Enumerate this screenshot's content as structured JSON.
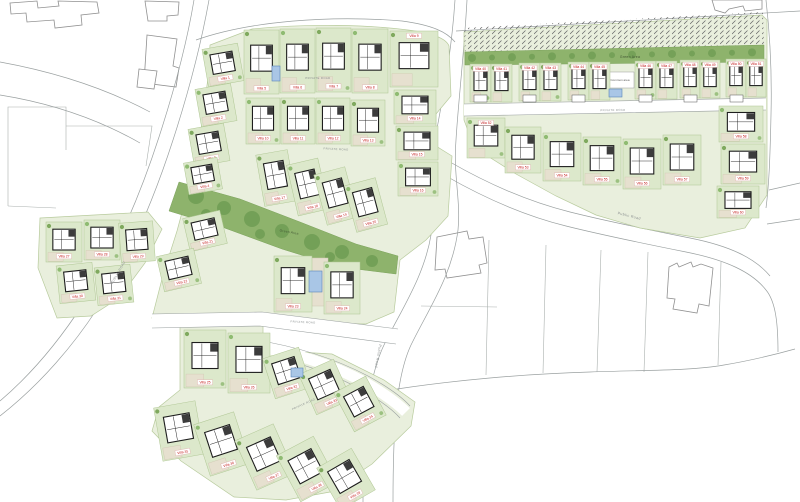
{
  "labels": {
    "green_area": "Green Area",
    "common_area": "Common area",
    "private_road": "PRIVATE ROAD",
    "public_road": "Public Road",
    "public_road_upper": "PUBLIC ROAD"
  },
  "colors": {
    "plot_green": "#dce8cb",
    "base_green": "#e9efdd",
    "band_green": "#8eb36c",
    "tree_dark": "#6f9c54",
    "tree_light": "#8fbb72",
    "terrace": "#e6e0cf",
    "villa_label": "#c52222",
    "road_line": "#9aa0a0",
    "pool": "#a9c6e6"
  },
  "villas": [
    {
      "label": "Villa 1",
      "x": 205,
      "y": 46,
      "w": 36,
      "h": 38,
      "r": -10
    },
    {
      "label": "Villa 2",
      "x": 198,
      "y": 86,
      "w": 36,
      "h": 38,
      "r": -10
    },
    {
      "label": "Villa 3",
      "x": 191,
      "y": 126,
      "w": 36,
      "h": 38,
      "r": -10
    },
    {
      "label": "Villa 4",
      "x": 186,
      "y": 160,
      "w": 34,
      "h": 32,
      "r": -10
    },
    {
      "label": "Villa 5",
      "x": 244,
      "y": 30,
      "w": 35,
      "h": 64,
      "r": 0
    },
    {
      "label": "Villa 6",
      "x": 280,
      "y": 29,
      "w": 35,
      "h": 64,
      "r": 0
    },
    {
      "label": "Villa 7",
      "x": 316,
      "y": 28,
      "w": 35,
      "h": 64,
      "r": 0
    },
    {
      "label": "Villa 8",
      "x": 352,
      "y": 29,
      "w": 36,
      "h": 64,
      "r": 0
    },
    {
      "label": "Villa 9",
      "x": 390,
      "y": 31,
      "w": 48,
      "h": 56,
      "r": 0,
      "lp": "t"
    },
    {
      "label": "Villa 10",
      "x": 246,
      "y": 98,
      "w": 34,
      "h": 46,
      "r": 0
    },
    {
      "label": "Villa 11",
      "x": 281,
      "y": 98,
      "w": 34,
      "h": 46,
      "r": 0
    },
    {
      "label": "Villa 12",
      "x": 316,
      "y": 98,
      "w": 34,
      "h": 46,
      "r": 0
    },
    {
      "label": "Villa 13",
      "x": 351,
      "y": 100,
      "w": 34,
      "h": 46,
      "r": 0
    },
    {
      "label": "Villa 14",
      "x": 394,
      "y": 90,
      "w": 42,
      "h": 34,
      "r": 0
    },
    {
      "label": "Villa 15",
      "x": 396,
      "y": 126,
      "w": 42,
      "h": 34,
      "r": 0
    },
    {
      "label": "Villa 16",
      "x": 398,
      "y": 162,
      "w": 40,
      "h": 34,
      "r": 0
    },
    {
      "label": "Villa 17",
      "x": 260,
      "y": 152,
      "w": 32,
      "h": 52,
      "r": -10
    },
    {
      "label": "Villa 18",
      "x": 292,
      "y": 161,
      "w": 32,
      "h": 52,
      "r": -13
    },
    {
      "label": "Villa 19",
      "x": 320,
      "y": 170,
      "w": 32,
      "h": 52,
      "r": -15
    },
    {
      "label": "Villa 20",
      "x": 350,
      "y": 181,
      "w": 32,
      "h": 48,
      "r": -15
    },
    {
      "label": "Villa 21",
      "x": 186,
      "y": 214,
      "w": 38,
      "h": 34,
      "r": -13
    },
    {
      "label": "Villa 22",
      "x": 160,
      "y": 252,
      "w": 38,
      "h": 36,
      "r": -13
    },
    {
      "label": "Villa 23",
      "x": 274,
      "y": 256,
      "w": 38,
      "h": 56,
      "r": 0
    },
    {
      "label": "Villa 24",
      "x": 324,
      "y": 262,
      "w": 36,
      "h": 52,
      "r": 0
    },
    {
      "label": "Villa 25",
      "x": 184,
      "y": 330,
      "w": 42,
      "h": 58,
      "r": 0
    },
    {
      "label": "Villa 26",
      "x": 228,
      "y": 333,
      "w": 42,
      "h": 60,
      "r": 0
    },
    {
      "label": "Villa 27",
      "x": 46,
      "y": 222,
      "w": 36,
      "h": 40,
      "r": 0
    },
    {
      "label": "Villa 28",
      "x": 84,
      "y": 220,
      "w": 36,
      "h": 40,
      "r": 0
    },
    {
      "label": "Villa 29",
      "x": 120,
      "y": 222,
      "w": 34,
      "h": 40,
      "r": -4
    },
    {
      "label": "Villa 30",
      "x": 58,
      "y": 264,
      "w": 36,
      "h": 38,
      "r": -6
    },
    {
      "label": "Villa 31",
      "x": 96,
      "y": 266,
      "w": 36,
      "h": 38,
      "r": -6
    },
    {
      "label": "Villa 32",
      "x": 268,
      "y": 352,
      "w": 38,
      "h": 42,
      "r": -18
    },
    {
      "label": "Villa 33",
      "x": 306,
      "y": 365,
      "w": 38,
      "h": 44,
      "r": -24
    },
    {
      "label": "Villa 34",
      "x": 342,
      "y": 382,
      "w": 36,
      "h": 44,
      "r": -28
    },
    {
      "label": "Villa 35",
      "x": 158,
      "y": 404,
      "w": 42,
      "h": 54,
      "r": -10
    },
    {
      "label": "Villa 36",
      "x": 201,
      "y": 417,
      "w": 42,
      "h": 54,
      "r": -18
    },
    {
      "label": "Villa 37",
      "x": 244,
      "y": 430,
      "w": 42,
      "h": 54,
      "r": -24
    },
    {
      "label": "Villa 38",
      "x": 286,
      "y": 443,
      "w": 42,
      "h": 52,
      "r": -28
    },
    {
      "label": "Villa 39",
      "x": 326,
      "y": 455,
      "w": 40,
      "h": 48,
      "r": -30
    },
    {
      "label": "Villa 40",
      "x": 470,
      "y": 64,
      "w": 21,
      "h": 38,
      "r": 0,
      "lp": "t"
    },
    {
      "label": "Villa 41",
      "x": 491,
      "y": 64,
      "w": 21,
      "h": 38,
      "r": 0,
      "lp": "t"
    },
    {
      "label": "Villa 42",
      "x": 519,
      "y": 63,
      "w": 21,
      "h": 38,
      "r": 0,
      "lp": "t"
    },
    {
      "label": "Villa 43",
      "x": 540,
      "y": 63,
      "w": 21,
      "h": 38,
      "r": 0,
      "lp": "t"
    },
    {
      "label": "Villa 44",
      "x": 568,
      "y": 62,
      "w": 21,
      "h": 38,
      "r": 0,
      "lp": "t"
    },
    {
      "label": "Villa 45",
      "x": 589,
      "y": 62,
      "w": 21,
      "h": 38,
      "r": 0,
      "lp": "t"
    },
    {
      "label": "Villa 46",
      "x": 635,
      "y": 61,
      "w": 21,
      "h": 38,
      "r": 0,
      "lp": "t"
    },
    {
      "label": "Villa 47",
      "x": 656,
      "y": 61,
      "w": 21,
      "h": 38,
      "r": 0,
      "lp": "t"
    },
    {
      "label": "Villa 48",
      "x": 680,
      "y": 60,
      "w": 20,
      "h": 38,
      "r": 0,
      "lp": "t"
    },
    {
      "label": "Villa 49",
      "x": 700,
      "y": 60,
      "w": 20,
      "h": 38,
      "r": 0,
      "lp": "t"
    },
    {
      "label": "Villa 50",
      "x": 726,
      "y": 59,
      "w": 20,
      "h": 38,
      "r": 0,
      "lp": "t"
    },
    {
      "label": "Villa 51",
      "x": 746,
      "y": 59,
      "w": 20,
      "h": 38,
      "r": 0,
      "lp": "t"
    },
    {
      "label": "Villa 52",
      "x": 467,
      "y": 118,
      "w": 38,
      "h": 40,
      "r": 0,
      "lp": "t"
    },
    {
      "label": "Villa 53",
      "x": 505,
      "y": 127,
      "w": 36,
      "h": 46,
      "r": 0
    },
    {
      "label": "Villa 54",
      "x": 543,
      "y": 133,
      "w": 38,
      "h": 48,
      "r": 0
    },
    {
      "label": "Villa 55",
      "x": 583,
      "y": 137,
      "w": 38,
      "h": 48,
      "r": 0
    },
    {
      "label": "Villa 56",
      "x": 623,
      "y": 139,
      "w": 38,
      "h": 50,
      "r": 0
    },
    {
      "label": "Villa 57",
      "x": 663,
      "y": 135,
      "w": 38,
      "h": 50,
      "r": 0
    },
    {
      "label": "Villa 58",
      "x": 719,
      "y": 106,
      "w": 44,
      "h": 36,
      "r": 0
    },
    {
      "label": "Villa 59",
      "x": 721,
      "y": 144,
      "w": 44,
      "h": 40,
      "r": 0
    },
    {
      "label": "Villa 60",
      "x": 717,
      "y": 186,
      "w": 42,
      "h": 32,
      "r": 0
    }
  ],
  "pools": [
    {
      "x": 309,
      "y": 271,
      "w": 13,
      "h": 21
    },
    {
      "x": 291,
      "y": 368,
      "w": 12,
      "h": 9
    },
    {
      "x": 272,
      "y": 66,
      "w": 8,
      "h": 15
    },
    {
      "x": 609,
      "y": 89,
      "w": 13,
      "h": 8
    }
  ]
}
